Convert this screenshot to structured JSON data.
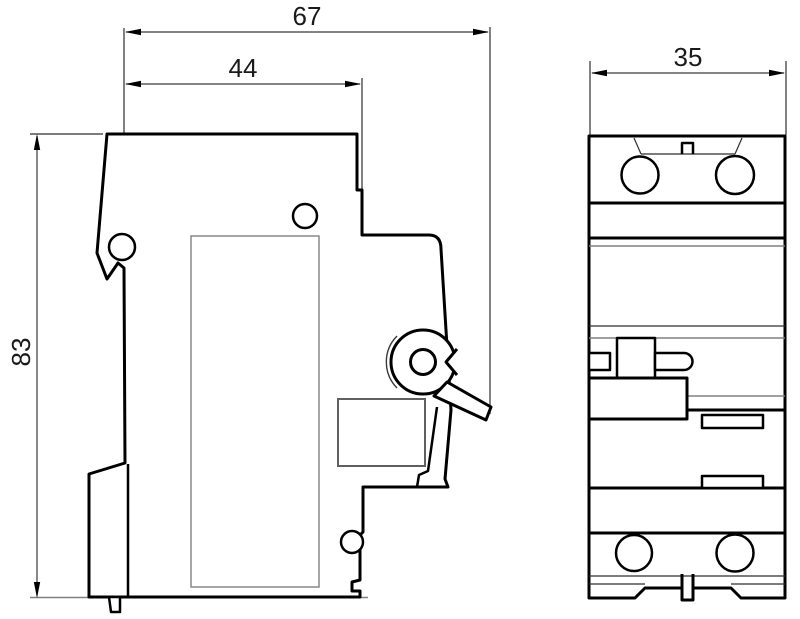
{
  "drawing": {
    "side_view": {
      "dimensions": {
        "overall_depth": "67",
        "body_depth": "44",
        "height": "83"
      }
    },
    "front_view": {
      "dimensions": {
        "width": "35"
      }
    },
    "colors": {
      "outline": "#000000",
      "dimension_line": "#3a3a3a",
      "detail_line": "#808080",
      "background": "#ffffff",
      "text": "#1a1a1a"
    }
  }
}
